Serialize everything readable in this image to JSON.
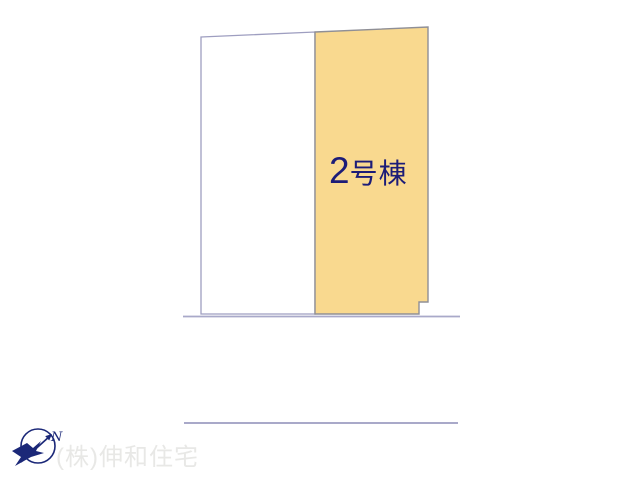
{
  "parcels": [
    {
      "id": "parcel-left",
      "label": "",
      "fill": "#FFFFFF",
      "border": "#9E9EC0"
    },
    {
      "id": "parcel-2",
      "label": "2号棟",
      "label_number": "2",
      "label_suffix": "号棟",
      "fill": "#F9D98F",
      "border": "#8F8F96",
      "label_color": "#1C1C78"
    }
  ],
  "compass": {
    "north_label": "N",
    "color": "#1B2878"
  },
  "watermark": {
    "text": "(株)伸和住宅",
    "color": "#E8E8E6"
  },
  "colors": {
    "road_line": "#A9A9C9",
    "background": "#FFFFFF"
  }
}
